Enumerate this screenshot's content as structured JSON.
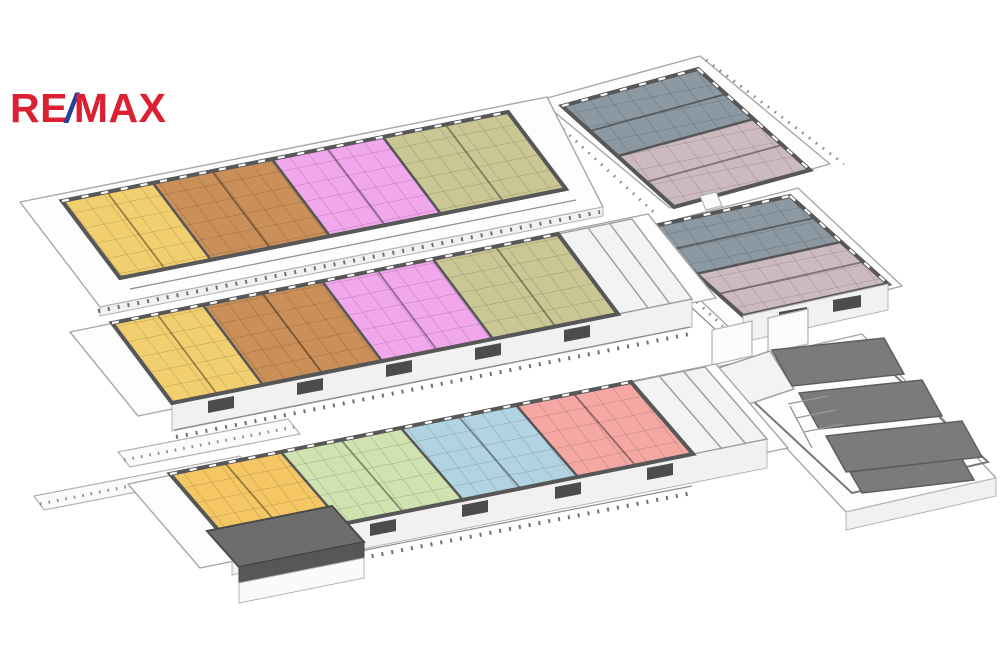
{
  "logo": {
    "text_re": "RE",
    "text_slash": "/",
    "text_max": "MAX"
  },
  "palette": {
    "logo_red": "#DB2032",
    "logo_blue": "#27409A",
    "wall": "#575757",
    "slab": "#fdfdfd",
    "slab_stroke": "#a7a7a7",
    "roof_dark": "#6d6d6d",
    "units": {
      "yellow": "#F2CF6E",
      "yellow_deep": "#F4C764",
      "orange": "#CB9059",
      "violet": "#F1A7EB",
      "olive": "#CAC795",
      "slate": "#8C98A2",
      "mauve": "#CDBAC0",
      "lightgreen": "#CFE2B0",
      "lightblue": "#B2D4E2",
      "salmon": "#F5A8A3",
      "garage": "#7b7b7b"
    }
  },
  "buildings": [
    {
      "id": "upper-left-wing",
      "units": [
        "yellow",
        "orange",
        "violet",
        "olive"
      ]
    },
    {
      "id": "upper-right-block",
      "units": [
        "slate",
        "mauve"
      ]
    },
    {
      "id": "middle-left-wing",
      "units": [
        "yellow",
        "orange",
        "violet",
        "olive"
      ]
    },
    {
      "id": "middle-right-block",
      "units": [
        "slate",
        "mauve"
      ]
    },
    {
      "id": "lower-left-wing",
      "units": [
        "yellow_deep",
        "lightgreen",
        "lightblue",
        "salmon"
      ]
    },
    {
      "id": "lower-right-garage",
      "units": [
        "garage"
      ]
    }
  ]
}
